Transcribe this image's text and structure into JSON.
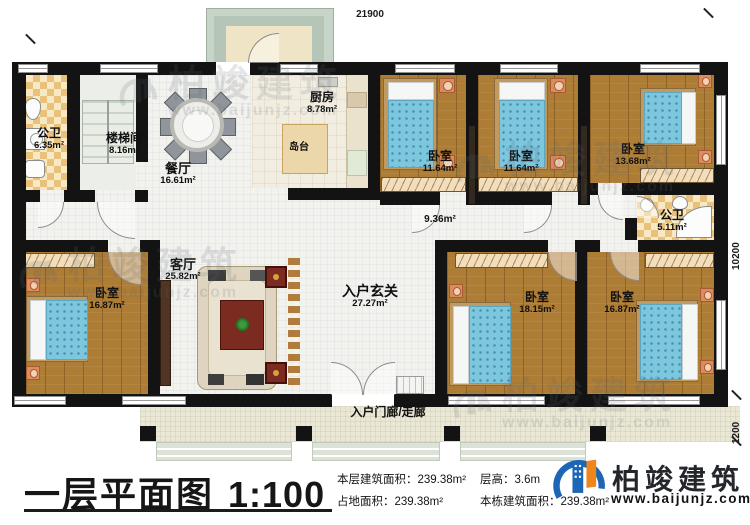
{
  "plan": {
    "dims": {
      "top": "21900",
      "side_main": "10200",
      "side_porch": "1200"
    },
    "rooms": {
      "bath1": {
        "name": "公卫",
        "area": "6.35m²"
      },
      "stairwell": {
        "name": "楼梯间",
        "area": "8.16m²"
      },
      "dining": {
        "name": "餐厅",
        "area": "16.61m²"
      },
      "kitchen": {
        "name": "厨房",
        "area": "8.78m²"
      },
      "island": {
        "name": "岛台"
      },
      "bedroom_top_1": {
        "name": "卧室",
        "area": "11.64m²"
      },
      "bedroom_top_2": {
        "name": "卧室",
        "area": "11.64m²"
      },
      "bedroom_top_3": {
        "name": "卧室",
        "area": "13.68m²"
      },
      "hallway": {
        "area": "9.36m²"
      },
      "bath2": {
        "name": "公卫",
        "area": "5.11m²"
      },
      "bedroom_left": {
        "name": "卧室",
        "area": "16.87m²"
      },
      "living": {
        "name": "客厅",
        "area": "25.82m²"
      },
      "foyer": {
        "name": "入户玄关",
        "area": "27.27m²"
      },
      "bedroom_bottom_1": {
        "name": "卧室",
        "area": "18.15m²"
      },
      "bedroom_bottom_2": {
        "name": "卧室",
        "area": "16.87m²"
      },
      "porch": {
        "name": "入户门廊/走廊"
      }
    }
  },
  "watermark": {
    "name": "柏竣建筑",
    "url": "www.baijunjz.com"
  },
  "footer": {
    "title": "一层平面图",
    "scale": "1:100",
    "stats": [
      {
        "label": "本层建筑面积：",
        "value": "239.38m²"
      },
      {
        "label": "占地面积：",
        "value": "239.38m²"
      },
      {
        "label": "层高：",
        "value": "3.6m"
      },
      {
        "label": "本栋建筑面积：",
        "value": "239.38m²"
      }
    ],
    "brand": {
      "name": "柏竣建筑",
      "url": "www.baijunjz.com"
    }
  }
}
